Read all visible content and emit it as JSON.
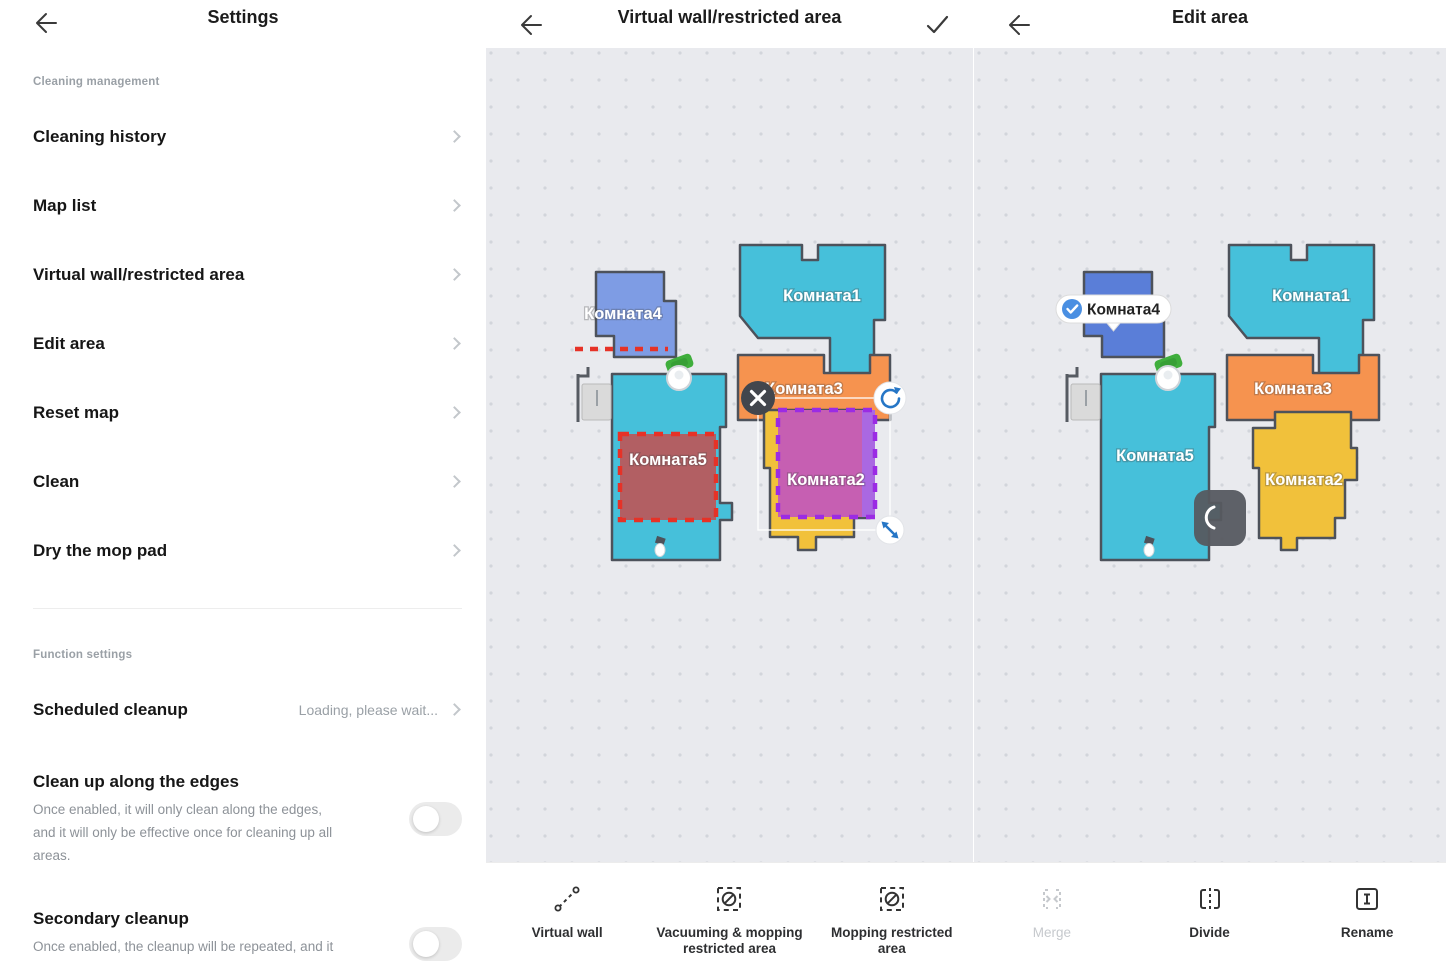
{
  "app": {
    "panels": {
      "settings": {
        "title": "Settings",
        "sections": [
          {
            "header": "Cleaning management",
            "items": [
              "Cleaning history",
              "Map list",
              "Virtual wall/restricted area",
              "Edit area",
              "Reset map",
              "Clean",
              "Dry the mop pad"
            ]
          },
          {
            "header": "Function settings"
          }
        ],
        "scheduled": {
          "label": "Scheduled cleanup",
          "status": "Loading, please wait..."
        },
        "edge_cleanup": {
          "label": "Clean up along the edges",
          "description": "Once enabled, it will only clean along the edges, and it will only be effective once for cleaning up all areas.",
          "toggle_state": "off"
        },
        "secondary_cleanup": {
          "label": "Secondary cleanup",
          "description": "Once enabled, the cleanup will be repeated, and it",
          "toggle_state": "off"
        }
      },
      "virtual_wall": {
        "title": "Virtual wall/restricted area"
      },
      "edit_area": {
        "title": "Edit area",
        "selected_room": "Комната4"
      }
    },
    "rooms": {
      "r1": "Комната1",
      "r2": "Комната2",
      "r3": "Комната3",
      "r4": "Комната4",
      "r5": "Комната5"
    },
    "colors": {
      "teal": "#46c0da",
      "blue_room": "#7e9ce4",
      "blue_room_selected": "#5a7ed8",
      "orange": "#f6934f",
      "yellow": "#f1c13b",
      "restricted_fill": "#b25f63",
      "restricted_border": "#e63227",
      "mop_zone_fill": "#c65fb2",
      "mop_zone_outer": "#aa68e2",
      "mop_zone_border": "#9b2be4",
      "virtual_wall_red": "#e63227",
      "handle_blue": "#2676c6",
      "map_background": "#e9eaee",
      "wall_stroke": "#4d525b",
      "dock_green": "#3fae3c"
    },
    "toolbar": {
      "items": [
        {
          "label": "Virtual wall",
          "icon": "virtual-wall-icon",
          "enabled": true
        },
        {
          "label": "Vacuuming & mopping restricted area",
          "icon": "no-vacuum-mop-zone-icon",
          "enabled": true
        },
        {
          "label": "Mopping restricted area",
          "icon": "no-mop-zone-icon",
          "enabled": true
        },
        {
          "label": "Merge",
          "icon": "merge-icon",
          "enabled": false
        },
        {
          "label": "Divide",
          "icon": "divide-icon",
          "enabled": true
        },
        {
          "label": "Rename",
          "icon": "rename-icon",
          "enabled": true
        }
      ]
    }
  }
}
